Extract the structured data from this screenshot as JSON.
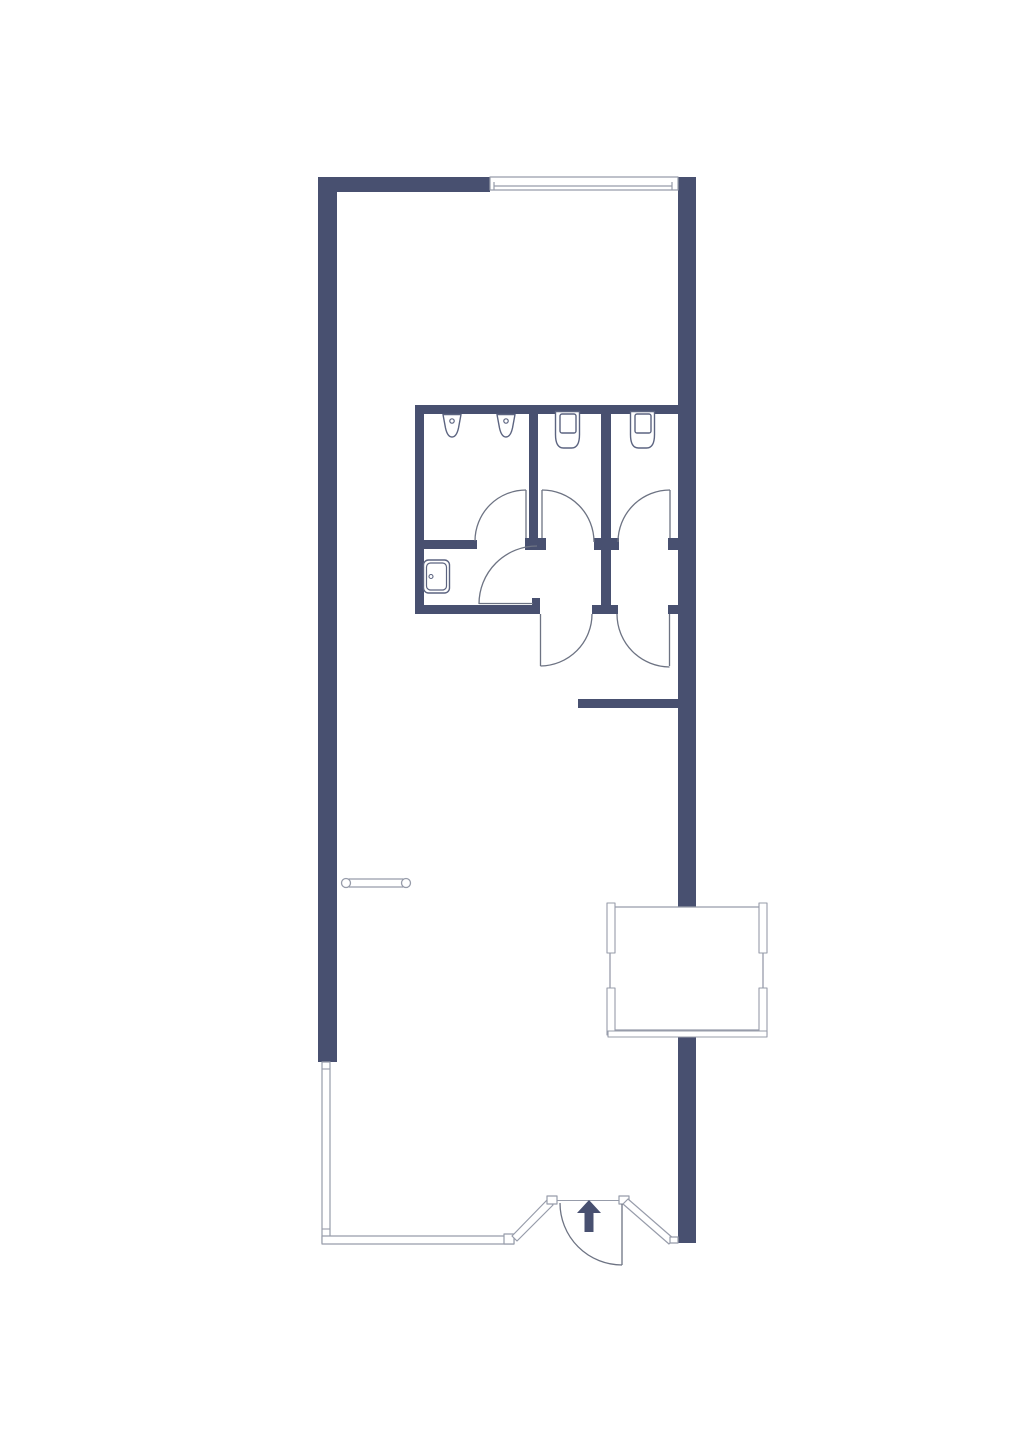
{
  "title": "floor-plan",
  "canvas": {
    "width": 1014,
    "height": 1440,
    "background": "#ffffff"
  },
  "colors": {
    "wall": "#485070",
    "thin": "#979caa",
    "door": "#6d7383",
    "fixture": "#5c6480",
    "white": "#ffffff"
  },
  "shapes": [
    {
      "name": "exterior-wall-left",
      "type": "rect",
      "fill": "wall",
      "attrs": {
        "x": 318,
        "y": 177,
        "width": 19,
        "height": 885
      }
    },
    {
      "name": "exterior-wall-top",
      "type": "rect",
      "fill": "wall",
      "attrs": {
        "x": 318,
        "y": 177,
        "width": 172,
        "height": 15
      }
    },
    {
      "name": "exterior-wall-right",
      "type": "rect",
      "fill": "wall",
      "attrs": {
        "x": 678,
        "y": 177,
        "width": 18,
        "height": 1066
      }
    },
    {
      "name": "bathroom-wall-top",
      "type": "rect",
      "fill": "wall",
      "attrs": {
        "x": 415,
        "y": 405,
        "width": 263,
        "height": 9
      }
    },
    {
      "name": "bathroom-wall-left",
      "type": "rect",
      "fill": "wall",
      "attrs": {
        "x": 415,
        "y": 405,
        "width": 9,
        "height": 209
      }
    },
    {
      "name": "bathroom-wall-mid",
      "type": "rect",
      "fill": "wall",
      "attrs": {
        "x": 415,
        "y": 540,
        "width": 62,
        "height": 9
      }
    },
    {
      "name": "bathroom-wall-bottom",
      "type": "rect",
      "fill": "wall",
      "attrs": {
        "x": 415,
        "y": 605,
        "width": 125,
        "height": 9
      }
    },
    {
      "name": "bathroom-wall-bottom-notch",
      "type": "rect",
      "fill": "wall",
      "attrs": {
        "x": 532,
        "y": 598,
        "width": 8,
        "height": 8
      }
    },
    {
      "name": "stall-divider-a",
      "type": "rect",
      "fill": "wall",
      "attrs": {
        "x": 529,
        "y": 405,
        "width": 9,
        "height": 145
      }
    },
    {
      "name": "stall-divider-a-stub",
      "type": "rect",
      "fill": "wall",
      "attrs": {
        "x": 525,
        "y": 538,
        "width": 21,
        "height": 12
      }
    },
    {
      "name": "stall-divider-b",
      "type": "rect",
      "fill": "wall",
      "attrs": {
        "x": 601,
        "y": 405,
        "width": 10,
        "height": 209
      }
    },
    {
      "name": "stall-divider-b-stub",
      "type": "rect",
      "fill": "wall",
      "attrs": {
        "x": 594,
        "y": 538,
        "width": 25,
        "height": 12
      }
    },
    {
      "name": "stall-divider-b-base",
      "type": "rect",
      "fill": "wall",
      "attrs": {
        "x": 592,
        "y": 605,
        "width": 26,
        "height": 9
      }
    },
    {
      "name": "right-wall-stub-mid",
      "type": "rect",
      "fill": "wall",
      "attrs": {
        "x": 668,
        "y": 538,
        "width": 10,
        "height": 12
      }
    },
    {
      "name": "right-wall-stub-bottom",
      "type": "rect",
      "fill": "wall",
      "attrs": {
        "x": 668,
        "y": 605,
        "width": 10,
        "height": 9
      }
    },
    {
      "name": "corridor-wall-stub",
      "type": "rect",
      "fill": "wall",
      "attrs": {
        "x": 578,
        "y": 699,
        "width": 100,
        "height": 9
      }
    },
    {
      "name": "desk",
      "type": "rect",
      "fill": "white",
      "stroke": "thin",
      "sw": 1.3,
      "attrs": {
        "x": 610,
        "y": 907,
        "width": 153,
        "height": 123
      }
    },
    {
      "name": "desk-edge-left-top",
      "type": "rect",
      "fill": "white",
      "stroke": "thin",
      "sw": 1.1,
      "attrs": {
        "x": 607,
        "y": 903,
        "width": 8,
        "height": 50
      }
    },
    {
      "name": "desk-edge-left-bottom",
      "type": "rect",
      "fill": "white",
      "stroke": "thin",
      "sw": 1.1,
      "attrs": {
        "x": 607,
        "y": 988,
        "width": 8,
        "height": 47
      }
    },
    {
      "name": "desk-edge-right-top",
      "type": "rect",
      "fill": "white",
      "stroke": "thin",
      "sw": 1.1,
      "attrs": {
        "x": 759,
        "y": 903,
        "width": 8,
        "height": 50
      }
    },
    {
      "name": "desk-edge-right-bottom",
      "type": "rect",
      "fill": "white",
      "stroke": "thin",
      "sw": 1.1,
      "attrs": {
        "x": 759,
        "y": 988,
        "width": 8,
        "height": 47
      }
    },
    {
      "name": "desk-edge-bottom",
      "type": "rect",
      "fill": "white",
      "stroke": "thin",
      "sw": 1.1,
      "attrs": {
        "x": 608,
        "y": 1031,
        "width": 159,
        "height": 6
      }
    },
    {
      "name": "window-top",
      "type": "rect",
      "fill": "white",
      "stroke": "thin",
      "sw": 1.2,
      "attrs": {
        "x": 490,
        "y": 177,
        "width": 188,
        "height": 13
      }
    },
    {
      "name": "window-glazing-line",
      "type": "line",
      "stroke": "thin",
      "sw": 1.2,
      "attrs": {
        "x1": 494,
        "y1": 186,
        "x2": 672,
        "y2": 186
      }
    },
    {
      "name": "window-tick-left",
      "type": "line",
      "stroke": "thin",
      "sw": 1.2,
      "attrs": {
        "x1": 494,
        "y1": 182,
        "x2": 494,
        "y2": 190
      }
    },
    {
      "name": "window-tick-right",
      "type": "line",
      "stroke": "thin",
      "sw": 1.2,
      "attrs": {
        "x1": 672,
        "y1": 182,
        "x2": 672,
        "y2": 190
      }
    },
    {
      "name": "glass-wall-left",
      "type": "rect",
      "fill": "white",
      "stroke": "thin",
      "sw": 1.2,
      "attrs": {
        "x": 322,
        "y": 1062,
        "width": 8,
        "height": 181
      }
    },
    {
      "name": "glass-wall-left-tick-top",
      "type": "line",
      "stroke": "thin",
      "sw": 1.1,
      "attrs": {
        "x1": 322,
        "y1": 1069,
        "x2": 330,
        "y2": 1069
      }
    },
    {
      "name": "glass-wall-left-tick-bottom",
      "type": "line",
      "stroke": "thin",
      "sw": 1.1,
      "attrs": {
        "x1": 322,
        "y1": 1229,
        "x2": 330,
        "y2": 1229
      }
    },
    {
      "name": "glass-wall-bottom",
      "type": "rect",
      "fill": "white",
      "stroke": "thin",
      "sw": 1.2,
      "attrs": {
        "x": 322,
        "y": 1236,
        "width": 192,
        "height": 8
      }
    },
    {
      "name": "glass-wall-bottom-post",
      "type": "rect",
      "fill": "white",
      "stroke": "thin",
      "sw": 1.2,
      "attrs": {
        "x": 504,
        "y": 1234,
        "width": 10,
        "height": 10
      }
    },
    {
      "name": "glass-wall-angled-left",
      "type": "polygon",
      "fill": "white",
      "stroke": "thin",
      "sw": 1.2,
      "attrs": {
        "points": "548,1199 553,1205 517,1241 512,1236"
      }
    },
    {
      "name": "entry-post-left",
      "type": "rect",
      "fill": "white",
      "stroke": "thin",
      "sw": 1.2,
      "attrs": {
        "x": 547,
        "y": 1196,
        "width": 10,
        "height": 8
      }
    },
    {
      "name": "entry-header-line",
      "type": "line",
      "stroke": "thin",
      "sw": 1.1,
      "attrs": {
        "x1": 557,
        "y1": 1200.5,
        "x2": 620,
        "y2": 1200.5
      }
    },
    {
      "name": "entry-post-right",
      "type": "rect",
      "fill": "white",
      "stroke": "thin",
      "sw": 1.2,
      "attrs": {
        "x": 619,
        "y": 1196,
        "width": 10,
        "height": 8
      }
    },
    {
      "name": "glass-wall-angled-right",
      "type": "polygon",
      "fill": "white",
      "stroke": "thin",
      "sw": 1.2,
      "attrs": {
        "points": "628,1199 674,1239 669,1244 623,1204"
      }
    },
    {
      "name": "right-wall-end-notch",
      "type": "rect",
      "fill": "white",
      "stroke": "thin",
      "sw": 1.2,
      "attrs": {
        "x": 670,
        "y": 1237,
        "width": 8,
        "height": 6
      }
    },
    {
      "name": "urinal-room-door-leaf",
      "type": "line",
      "stroke": "door",
      "sw": 1.3,
      "attrs": {
        "x1": 526,
        "y1": 490,
        "x2": 526,
        "y2": 538
      }
    },
    {
      "name": "urinal-room-door-arc",
      "type": "path",
      "stroke": "door",
      "sw": 1.3,
      "attrs": {
        "d": "M475,541 A51,51 0 0 1 526,490"
      }
    },
    {
      "name": "sink-room-door-leaf",
      "type": "line",
      "stroke": "door",
      "sw": 1.3,
      "attrs": {
        "x1": 479,
        "y1": 603.5,
        "x2": 533,
        "y2": 603.5
      }
    },
    {
      "name": "sink-room-door-arc",
      "type": "path",
      "stroke": "door",
      "sw": 1.3,
      "attrs": {
        "d": "M479,604 A58,58 0 0 1 537,546"
      }
    },
    {
      "name": "stall-1-inner-door-leaf",
      "type": "line",
      "stroke": "door",
      "sw": 1.3,
      "attrs": {
        "x1": 542,
        "y1": 490,
        "x2": 542,
        "y2": 538
      }
    },
    {
      "name": "stall-1-inner-door-arc",
      "type": "path",
      "stroke": "door",
      "sw": 1.3,
      "attrs": {
        "d": "M542,490 A52,52 0 0 1 594,542"
      }
    },
    {
      "name": "stall-2-inner-door-leaf",
      "type": "line",
      "stroke": "door",
      "sw": 1.3,
      "attrs": {
        "x1": 670,
        "y1": 490,
        "x2": 670,
        "y2": 538
      }
    },
    {
      "name": "stall-2-inner-door-arc",
      "type": "path",
      "stroke": "door",
      "sw": 1.3,
      "attrs": {
        "d": "M618,542 A52,52 0 0 1 670,490"
      }
    },
    {
      "name": "stall-1-door-leaf",
      "type": "line",
      "stroke": "door",
      "sw": 1.3,
      "attrs": {
        "x1": 540.5,
        "y1": 614,
        "x2": 540.5,
        "y2": 666
      }
    },
    {
      "name": "stall-1-door-arc",
      "type": "path",
      "stroke": "door",
      "sw": 1.3,
      "attrs": {
        "d": "M592,614 A52,52 0 0 1 540.5,666"
      }
    },
    {
      "name": "stall-2-door-leaf",
      "type": "line",
      "stroke": "door",
      "sw": 1.3,
      "attrs": {
        "x1": 669.5,
        "y1": 614,
        "x2": 669.5,
        "y2": 666
      }
    },
    {
      "name": "stall-2-door-arc",
      "type": "path",
      "stroke": "door",
      "sw": 1.3,
      "attrs": {
        "d": "M617,614 A53,53 0 0 0 669.5,667"
      }
    },
    {
      "name": "entry-door-leaf",
      "type": "line",
      "stroke": "door",
      "sw": 1.3,
      "attrs": {
        "x1": 622,
        "y1": 1204,
        "x2": 622,
        "y2": 1265
      }
    },
    {
      "name": "entry-door-arc",
      "type": "path",
      "stroke": "door",
      "sw": 1.3,
      "attrs": {
        "d": "M560,1203 A62,62 0 0 0 622,1265"
      }
    },
    {
      "name": "urinal-1",
      "type": "path",
      "fill": "white",
      "stroke": "fixture",
      "sw": 1.4,
      "attrs": {
        "d": "M443,414.5 L461,414.5 L458.5,428 Q456.5,437 452,437 Q447.5,437 445.5,428 Z"
      }
    },
    {
      "name": "urinal-1-drain",
      "type": "circle",
      "fill": "white",
      "stroke": "fixture",
      "sw": 1.2,
      "attrs": {
        "cx": 452,
        "cy": 421,
        "r": 2.2
      }
    },
    {
      "name": "urinal-2",
      "type": "path",
      "fill": "white",
      "stroke": "fixture",
      "sw": 1.4,
      "attrs": {
        "d": "M497,414.5 L515,414.5 L512.5,428 Q510.5,437 506,437 Q501.5,437 499.5,428 Z"
      }
    },
    {
      "name": "urinal-2-drain",
      "type": "circle",
      "fill": "white",
      "stroke": "fixture",
      "sw": 1.2,
      "attrs": {
        "cx": 506,
        "cy": 421,
        "r": 2.2
      }
    },
    {
      "name": "toilet-1-bowl",
      "type": "path",
      "fill": "white",
      "stroke": "fixture",
      "sw": 1.4,
      "attrs": {
        "d": "M555.5,411.5 h24 v23 q0,13.5 -8,13.5 h-8 q-8,0 -8,-13.5 z"
      }
    },
    {
      "name": "toilet-1-tank",
      "type": "rect",
      "fill": "white",
      "stroke": "fixture",
      "sw": 1.4,
      "attrs": {
        "x": 560,
        "y": 414,
        "width": 16,
        "height": 19,
        "rx": 2
      }
    },
    {
      "name": "toilet-2-bowl",
      "type": "path",
      "fill": "white",
      "stroke": "fixture",
      "sw": 1.4,
      "attrs": {
        "d": "M630.5,411.5 h24 v23 q0,13.5 -8,13.5 h-8 q-8,0 -8,-13.5 z"
      }
    },
    {
      "name": "toilet-2-tank",
      "type": "rect",
      "fill": "white",
      "stroke": "fixture",
      "sw": 1.4,
      "attrs": {
        "x": 635,
        "y": 414,
        "width": 16,
        "height": 19,
        "rx": 2
      }
    },
    {
      "name": "sink-basin-outer",
      "type": "rect",
      "fill": "white",
      "stroke": "fixture",
      "sw": 1.4,
      "attrs": {
        "x": 423.5,
        "y": 560,
        "width": 26,
        "height": 33,
        "rx": 5
      }
    },
    {
      "name": "sink-basin-inner",
      "type": "rect",
      "fill": "white",
      "stroke": "fixture",
      "sw": 1.2,
      "attrs": {
        "x": 426.5,
        "y": 563,
        "width": 20,
        "height": 27,
        "rx": 4
      }
    },
    {
      "name": "sink-faucet",
      "type": "circle",
      "fill": "white",
      "stroke": "fixture",
      "sw": 1.1,
      "attrs": {
        "cx": 431,
        "cy": 576.5,
        "r": 2
      }
    },
    {
      "name": "radiator-bar",
      "type": "rect",
      "fill": "white",
      "stroke": "thin",
      "sw": 1.2,
      "attrs": {
        "x": 349,
        "y": 879,
        "width": 54,
        "height": 8
      }
    },
    {
      "name": "radiator-end-left",
      "type": "circle",
      "fill": "white",
      "stroke": "thin",
      "sw": 1.3,
      "attrs": {
        "cx": 346,
        "cy": 883,
        "r": 4.5
      }
    },
    {
      "name": "radiator-end-right",
      "type": "circle",
      "fill": "white",
      "stroke": "thin",
      "sw": 1.3,
      "attrs": {
        "cx": 406,
        "cy": 883,
        "r": 4.5
      }
    },
    {
      "name": "entry-direction-arrow",
      "type": "polygon",
      "fill": "wall",
      "attrs": {
        "points": "589,1200 601,1213 593.5,1213 593.5,1232 584.5,1232 584.5,1213 577,1213"
      }
    }
  ]
}
